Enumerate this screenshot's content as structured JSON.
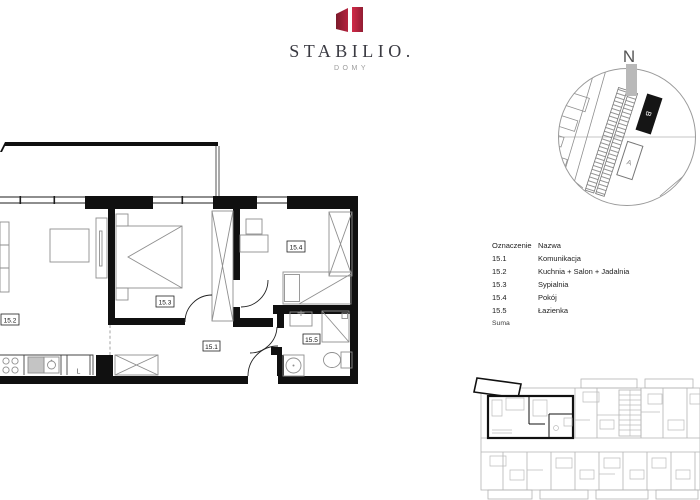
{
  "logo": {
    "title": "STABILIO.",
    "subtitle": "DOMY"
  },
  "site_map": {
    "north_label": "N",
    "building_b_label": "B",
    "building_a_label": "A"
  },
  "floor_plan": {
    "labels": {
      "komunikacja": "15.1",
      "kuchnia_salon": "15.2",
      "sypialnia": "15.3",
      "pokoj": "15.4",
      "lazienka": "15.5"
    },
    "fridge_label": "L"
  },
  "legend": {
    "header": {
      "id": "Oznaczenie",
      "name": "Nazwa"
    },
    "rows": [
      {
        "id": "15.1",
        "name": "Komunikacja"
      },
      {
        "id": "15.2",
        "name": "Kuchnia + Salon + Jadalnia"
      },
      {
        "id": "15.3",
        "name": "Sypialnia"
      },
      {
        "id": "15.4",
        "name": "Pokój"
      },
      {
        "id": "15.5",
        "name": "Łazienka"
      }
    ],
    "footer": "Suma"
  },
  "colors": {
    "logo_left_dark": "#7c1b2b",
    "logo_left_light": "#b5233f",
    "logo_right_light": "#d12a48",
    "logo_right_dark": "#921d33",
    "wall": "#101010",
    "furniture_gray": "#8f8f8f",
    "keyplan_gray": "#b4b4b4",
    "north_bar_gray": "#b9b9b9"
  }
}
